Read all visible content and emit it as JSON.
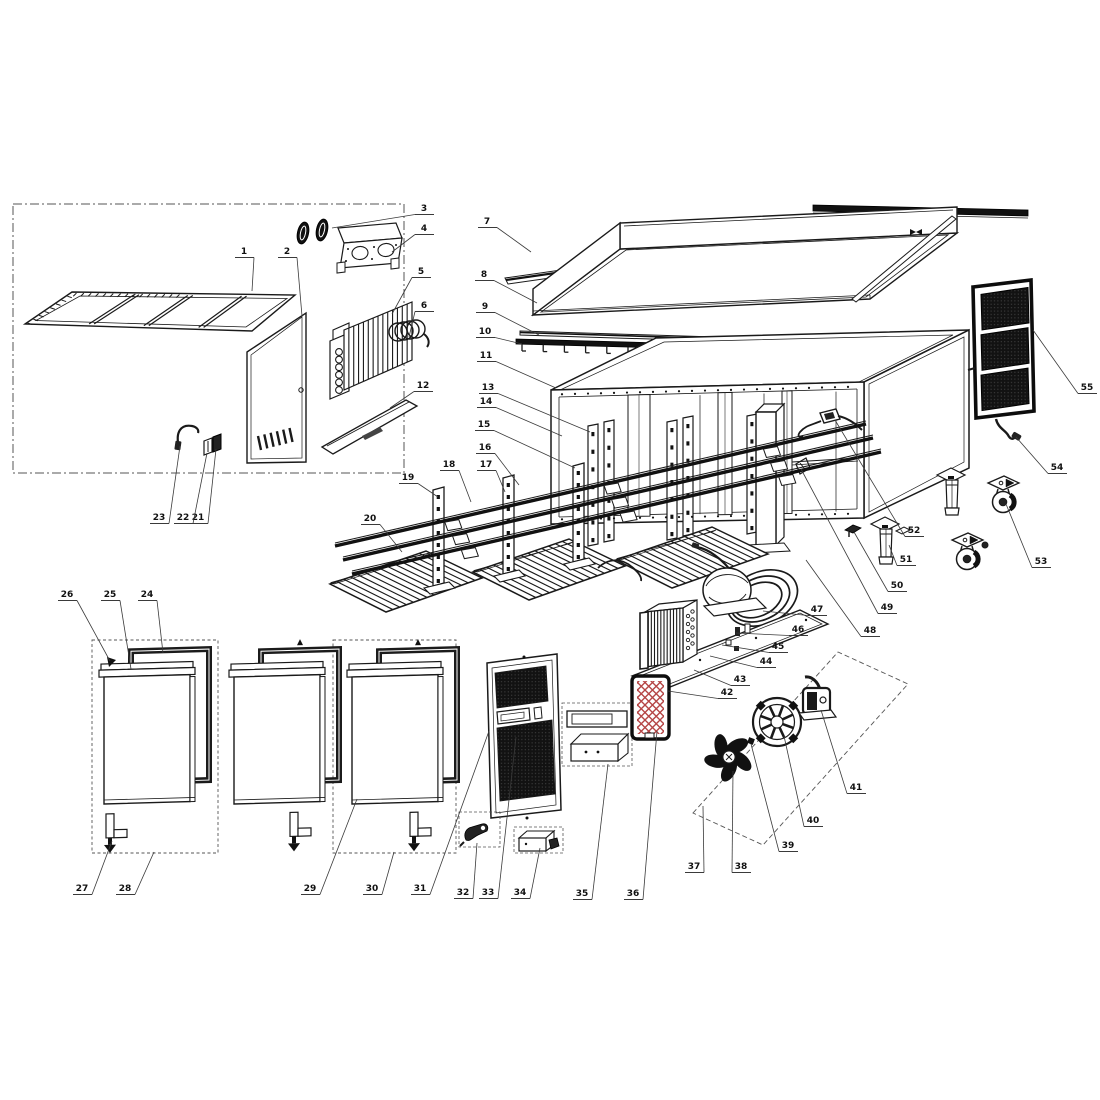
{
  "diagram": {
    "kind": "exploded-parts-diagram",
    "canvas": {
      "width": 1100,
      "height": 1100
    },
    "colors": {
      "background": "#ffffff",
      "line": "#1a1a1a",
      "leader": "#3a3a3a",
      "label_text": "#111111",
      "dark_fill": "#141414",
      "filter_red": "#b54545"
    },
    "parts": [
      {
        "num": "1",
        "name": "top-grille-frame",
        "lx": 244,
        "ly": 254,
        "tx": 252,
        "ty": 291
      },
      {
        "num": "2",
        "name": "rear-access-panel",
        "lx": 287,
        "ly": 254,
        "tx": 302,
        "ty": 316
      },
      {
        "num": "3",
        "name": "grommet-pair",
        "lx": 424,
        "ly": 211,
        "tx": 332,
        "ty": 228
      },
      {
        "num": "4",
        "name": "fan-bracket",
        "lx": 424,
        "ly": 231,
        "tx": 392,
        "ty": 252
      },
      {
        "num": "5",
        "name": "evaporator-coil",
        "lx": 421,
        "ly": 274,
        "tx": 392,
        "ty": 314
      },
      {
        "num": "6",
        "name": "capillary-coil",
        "lx": 424,
        "ly": 308,
        "tx": 409,
        "ty": 337
      },
      {
        "num": "7",
        "name": "top-rail",
        "lx": 487,
        "ly": 224,
        "tx": 531,
        "ty": 252
      },
      {
        "num": "8",
        "name": "worktop",
        "lx": 484,
        "ly": 277,
        "tx": 537,
        "ty": 303
      },
      {
        "num": "9",
        "name": "trim-strip",
        "lx": 485,
        "ly": 309,
        "tx": 539,
        "ty": 335
      },
      {
        "num": "10",
        "name": "hanger-rail",
        "lx": 485,
        "ly": 334,
        "tx": 522,
        "ty": 344
      },
      {
        "num": "11",
        "name": "cabinet-body",
        "lx": 486,
        "ly": 358,
        "tx": 556,
        "ty": 388
      },
      {
        "num": "12",
        "name": "mounting-channel",
        "lx": 423,
        "ly": 388,
        "tx": 390,
        "ty": 408
      },
      {
        "num": "13",
        "name": "shelf-pilaster",
        "lx": 488,
        "ly": 390,
        "tx": 590,
        "ty": 432
      },
      {
        "num": "14",
        "name": "shelf-pilaster",
        "lx": 486,
        "ly": 404,
        "tx": 562,
        "ty": 436
      },
      {
        "num": "15",
        "name": "shelf-pilaster",
        "lx": 484,
        "ly": 427,
        "tx": 575,
        "ty": 468
      },
      {
        "num": "16",
        "name": "shelf-rail",
        "lx": 485,
        "ly": 450,
        "tx": 519,
        "ty": 485
      },
      {
        "num": "17",
        "name": "shelf-rail",
        "lx": 486,
        "ly": 467,
        "tx": 505,
        "ty": 492
      },
      {
        "num": "18",
        "name": "shelf-rail",
        "lx": 449,
        "ly": 467,
        "tx": 471,
        "ty": 502
      },
      {
        "num": "19",
        "name": "shelf-post",
        "lx": 408,
        "ly": 480,
        "tx": 438,
        "ty": 497
      },
      {
        "num": "20",
        "name": "wire-shelf",
        "lx": 370,
        "ly": 521,
        "tx": 402,
        "ty": 552
      },
      {
        "num": "21",
        "name": "clamp",
        "lx": 198,
        "ly": 520,
        "tx": 216,
        "ty": 449
      },
      {
        "num": "22",
        "name": "clamp",
        "lx": 183,
        "ly": 520,
        "tx": 207,
        "ty": 453
      },
      {
        "num": "23",
        "name": "sensor-tube",
        "lx": 159,
        "ly": 520,
        "tx": 180,
        "ty": 446
      },
      {
        "num": "24",
        "name": "door-gasket",
        "lx": 147,
        "ly": 597,
        "tx": 163,
        "ty": 653
      },
      {
        "num": "25",
        "name": "door-panel",
        "lx": 110,
        "ly": 597,
        "tx": 131,
        "ty": 669
      },
      {
        "num": "26",
        "name": "door-top-cap",
        "lx": 67,
        "ly": 597,
        "tx": 110,
        "ty": 661
      },
      {
        "num": "27",
        "name": "door-hinge",
        "lx": 82,
        "ly": 891,
        "tx": 112,
        "ty": 841
      },
      {
        "num": "28",
        "name": "door-assembly",
        "lx": 125,
        "ly": 891,
        "tx": 154,
        "ty": 852
      },
      {
        "num": "29",
        "name": "door-panel-right",
        "lx": 310,
        "ly": 891,
        "tx": 357,
        "ty": 799
      },
      {
        "num": "30",
        "name": "door-assembly-right",
        "lx": 372,
        "ly": 891,
        "tx": 394,
        "ty": 852
      },
      {
        "num": "31",
        "name": "louvered-panel",
        "lx": 420,
        "ly": 891,
        "tx": 489,
        "ty": 731
      },
      {
        "num": "32",
        "name": "lock",
        "lx": 463,
        "ly": 895,
        "tx": 477,
        "ty": 843
      },
      {
        "num": "33",
        "name": "control-board",
        "lx": 488,
        "ly": 895,
        "tx": 516,
        "ty": 737
      },
      {
        "num": "34",
        "name": "junction-box",
        "lx": 520,
        "ly": 895,
        "tx": 540,
        "ty": 848
      },
      {
        "num": "35",
        "name": "thermostat-kit",
        "lx": 582,
        "ly": 896,
        "tx": 608,
        "ty": 764
      },
      {
        "num": "36",
        "name": "air-filter",
        "lx": 633,
        "ly": 896,
        "tx": 657,
        "ty": 731
      },
      {
        "num": "37",
        "name": "fan-partition",
        "lx": 694,
        "ly": 869,
        "tx": 703,
        "ty": 806
      },
      {
        "num": "38",
        "name": "fan-blade",
        "lx": 741,
        "ly": 869,
        "tx": 733,
        "ty": 771
      },
      {
        "num": "39",
        "name": "fan-nut",
        "lx": 788,
        "ly": 848,
        "tx": 751,
        "ty": 744
      },
      {
        "num": "40",
        "name": "fan-guard",
        "lx": 813,
        "ly": 823,
        "tx": 784,
        "ty": 736
      },
      {
        "num": "41",
        "name": "fan-motor",
        "lx": 856,
        "ly": 790,
        "tx": 821,
        "ty": 710
      },
      {
        "num": "42",
        "name": "compressor-deck",
        "lx": 727,
        "ly": 695,
        "tx": 668,
        "ty": 691
      },
      {
        "num": "43",
        "name": "condenser-coil",
        "lx": 740,
        "ly": 682,
        "tx": 694,
        "ty": 670
      },
      {
        "num": "44",
        "name": "drier-filter",
        "lx": 766,
        "ly": 664,
        "tx": 710,
        "ty": 656
      },
      {
        "num": "45",
        "name": "terminal-box",
        "lx": 778,
        "ly": 649,
        "tx": 722,
        "ty": 645
      },
      {
        "num": "46",
        "name": "compressor",
        "lx": 798,
        "ly": 632,
        "tx": 736,
        "ty": 633
      },
      {
        "num": "47",
        "name": "discharge-tubing",
        "lx": 817,
        "ly": 612,
        "tx": 763,
        "ty": 611
      },
      {
        "num": "48",
        "name": "drain-fitting",
        "lx": 870,
        "ly": 633,
        "tx": 806,
        "ty": 560
      },
      {
        "num": "49",
        "name": "mounting-bracket",
        "lx": 887,
        "ly": 610,
        "tx": 801,
        "ty": 469
      },
      {
        "num": "50",
        "name": "leg-clip",
        "lx": 897,
        "ly": 588,
        "tx": 854,
        "ty": 532
      },
      {
        "num": "51",
        "name": "adjustable-leg",
        "lx": 906,
        "ly": 562,
        "tx": 889,
        "ty": 545
      },
      {
        "num": "52",
        "name": "power-inlet",
        "lx": 914,
        "ly": 533,
        "tx": 835,
        "ty": 420
      },
      {
        "num": "53",
        "name": "caster",
        "lx": 1041,
        "ly": 564,
        "tx": 1006,
        "ty": 504
      },
      {
        "num": "54",
        "name": "power-cord",
        "lx": 1057,
        "ly": 470,
        "tx": 1016,
        "ty": 437
      },
      {
        "num": "55",
        "name": "condenser-grille",
        "lx": 1087,
        "ly": 390,
        "tx": 1033,
        "ty": 330
      }
    ]
  }
}
